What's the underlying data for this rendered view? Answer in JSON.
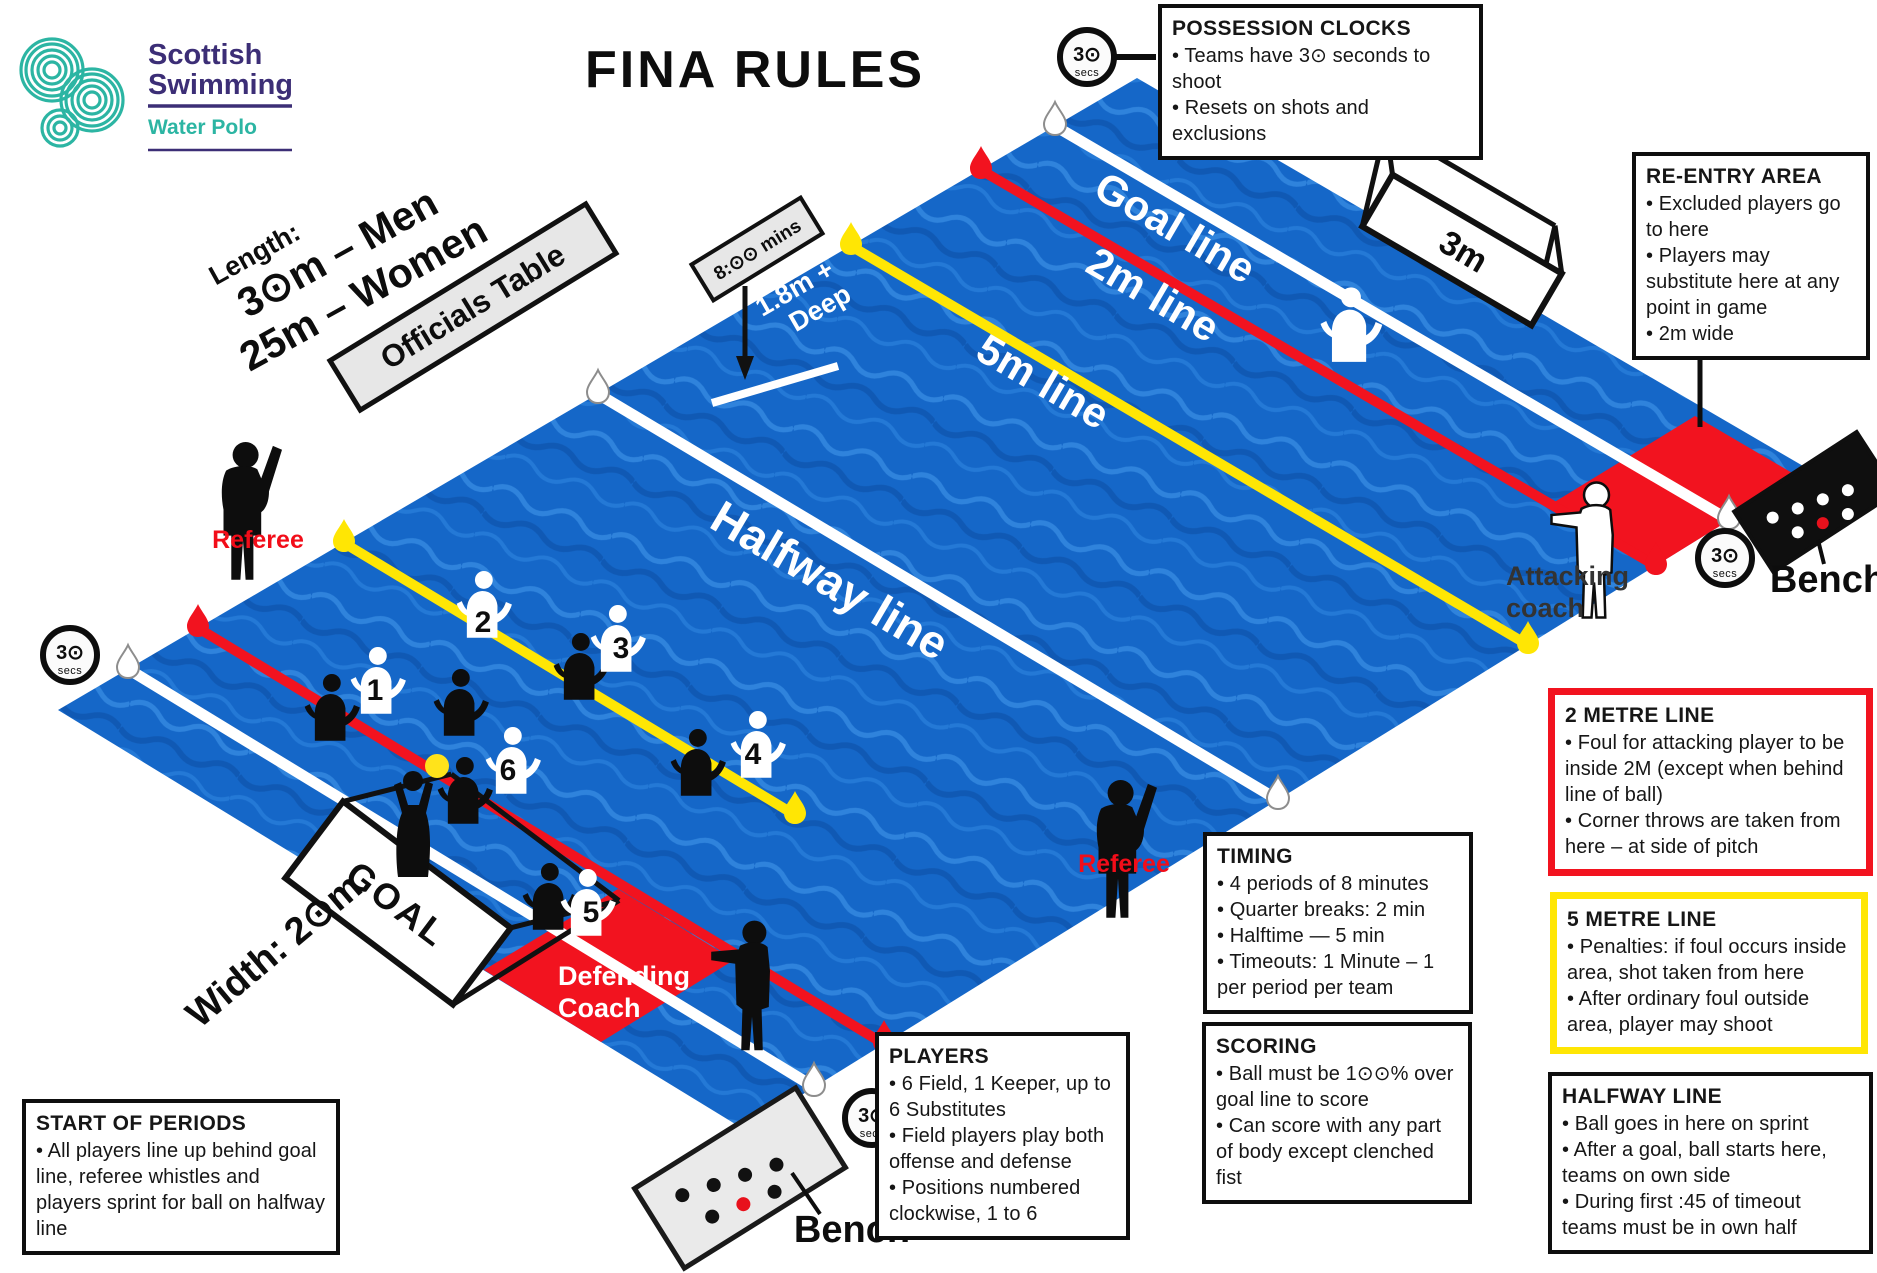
{
  "title": "FINA RULES",
  "logo": {
    "name": "Scottish",
    "name2": "Swimming",
    "division": "Water Polo"
  },
  "clock": {
    "value": "3⊙",
    "unit": "secs"
  },
  "colors": {
    "water": "#1567c8",
    "line_red": "#f2131f",
    "line_yellow": "#ffe604",
    "line_white": "#ffffff",
    "reentry_red": "#f2131f",
    "brand_teal": "#2cb5a3",
    "brand_purple": "#3c2e76",
    "referee_label_red": "#f20d19"
  },
  "pitch": {
    "lines": {
      "goal": "Goal line",
      "two": "2m line",
      "five": "5m line",
      "halfway": "Halfway line"
    },
    "goal_width": "3m",
    "goal_label": "GOAL",
    "length_label": "Length:",
    "length_men": "3⊙m – Men",
    "length_women": "25m – Women",
    "width_label": "Width: 2⊙m",
    "officials_table": "Officials Table",
    "match_clock": "8:⊙⊙ mins",
    "depth_line1": "1.8m +",
    "depth_line2": "Deep",
    "referee": "Referee",
    "defending_coach_line1": "Defending",
    "defending_coach_line2": "Coach",
    "attacking_coach_line1": "Attacking",
    "attacking_coach_line2": "coach",
    "bench": "Bench"
  },
  "players": {
    "numbers": [
      "1",
      "2",
      "3",
      "4",
      "5",
      "6"
    ]
  },
  "boxes": {
    "possession": {
      "title": "POSSESSION CLOCKS",
      "b0": "•  Teams have 3⊙ seconds to shoot",
      "b1": "•  Resets on shots and exclusions"
    },
    "reentry": {
      "title": "RE-ENTRY AREA",
      "b0": "•  Excluded players go to here",
      "b1": "•  Players may substitute here at any point in game",
      "b2": "• 2m wide"
    },
    "two_metre": {
      "title": "2 METRE LINE",
      "b0": "•  Foul for attacking player to be inside 2M (except when behind line of ball)",
      "b1": "•  Corner throws are taken from here – at side of pitch"
    },
    "five_metre": {
      "title": "5 METRE LINE",
      "b0": "•  Penalties: if foul occurs inside area, shot taken from here",
      "b1": "•  After ordinary foul outside area, player may shoot"
    },
    "halfway": {
      "title": "HALFWAY LINE",
      "b0": "•  Ball goes in here on sprint",
      "b1": "•  After a goal, ball starts here, teams on own side",
      "b2": "•  During first :45 of timeout teams must be in own half"
    },
    "timing": {
      "title": "TIMING",
      "b0": "•  4 periods of 8 minutes",
      "b1": "•  Quarter breaks: 2 min",
      "b2": "• Halftime — 5 min",
      "b3": "•  Timeouts: 1 Minute – 1 per period per team"
    },
    "scoring": {
      "title": "SCORING",
      "b0": "•  Ball must be 1⊙⊙% over goal line to score",
      "b1": "•  Can score with any part of body except clenched fist"
    },
    "players_box": {
      "title": "PLAYERS",
      "b0": "•  6 Field, 1 Keeper, up to 6 Substitutes",
      "b1": "•  Field players play both offense and defense",
      "b2": "•  Positions numbered clockwise, 1 to 6"
    },
    "start": {
      "title": "START OF PERIODS",
      "b0": "•  All players line up behind goal line, referee whistles and players sprint for ball on halfway line"
    }
  }
}
